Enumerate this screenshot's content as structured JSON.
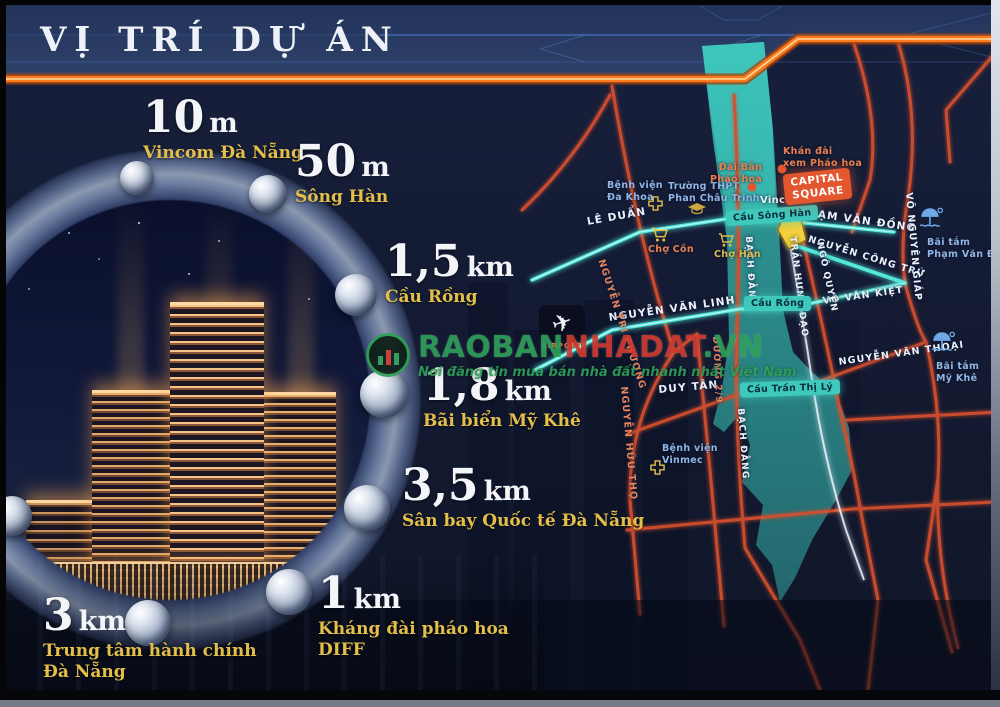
{
  "header": {
    "title": "VỊ TRÍ DỰ ÁN"
  },
  "distances": [
    {
      "value": "10",
      "unit": "m",
      "line1": "Vincom Đà Nẵng",
      "line2": ""
    },
    {
      "value": "50",
      "unit": "m",
      "line1": "Sông Hàn",
      "line2": ""
    },
    {
      "value": "1,5",
      "unit": "km",
      "line1": "Cầu Rồng",
      "line2": ""
    },
    {
      "value": "1,8",
      "unit": "km",
      "line1": "Bãi biển Mỹ Khê",
      "line2": ""
    },
    {
      "value": "3,5",
      "unit": "km",
      "line1": "Sân bay Quốc tế Đà Nẵng",
      "line2": ""
    },
    {
      "value": "1",
      "unit": "km",
      "line1": "Kháng đài pháo hoa",
      "line2": "DIFF"
    },
    {
      "value": "3",
      "unit": "km",
      "line1": "Trung tâm hành chính",
      "line2": "Đà Nẵng"
    }
  ],
  "map": {
    "streets": {
      "le_duan": "LÊ DUẨN",
      "pham_van_dong": "PHẠM VĂN ĐỒNG",
      "nguyen_cong_tru": "NGUYỄN CÔNG TRỨ",
      "vo_van_kiet": "VÕ VĂN KIỆT",
      "nguyen_van_linh": "NGUYỄN VĂN LINH",
      "nguyen_van_thoai": "NGUYỄN VĂN THOẠI",
      "duy_tan": "DUY TÂN",
      "vo_nguyen_giap": "VÕ NGUYÊN GIÁP",
      "bach_dang": "BẠCH ĐẰNG",
      "tran_hung_dao": "TRẦN HƯNG ĐẠO",
      "ngo_quyen": "NGÔ QUYỀN",
      "nguyen_tri_phuong": "NGUYỄN TRI PHƯƠNG",
      "nguyen_huu_tho": "NGUYỄN HỮU THỌ",
      "duong_2_9": "ĐƯỜNG 2/9"
    },
    "bridges": {
      "song_han": "Cầu Sông Hàn",
      "rong": "Cầu Rồng",
      "tran_thi_ly": "Cầu Trần Thị Lý"
    },
    "pois": {
      "benh_vien_da_khoa": {
        "line1": "Bệnh viện",
        "line2": "Đa Khoa"
      },
      "truong_thpt": {
        "line1": "Trường THPT",
        "line2": "Phan Châu Trinh"
      },
      "cho_con": "Chợ Cồn",
      "cho_han": "Chợ Hàn",
      "vincom": "Vincom",
      "khan_dai": {
        "line1": "Khán đài",
        "line2": "xem Pháo hoa"
      },
      "dai_ban": {
        "line1": "Đài Bắn",
        "line2": "Pháo hoa"
      },
      "capital_square": {
        "line1": "CAPITAL",
        "line2": "SQUARE"
      },
      "bai_tam_pvd": {
        "line1": "Bãi tắm",
        "line2": "Phạm Văn Đồng"
      },
      "bai_tam_my_khe": {
        "line1": "Bãi tắm",
        "line2": "Mỹ Khê"
      },
      "benh_vien_vinmec": {
        "line1": "Bệnh viện",
        "line2": "Vinmec"
      },
      "airport": "AIRPORT"
    },
    "colors": {
      "road_orange": "#d4502e",
      "road_teal": "#52e8da",
      "river": "#2f8f8f",
      "badge_orange": "#e4572e",
      "badge_teal": "#3fc8bc",
      "marker_yellow": "#f2cf3e",
      "label_gold": "#e3bf4a",
      "header_bar_orange": "#ff7a1a"
    }
  },
  "watermark": {
    "brand_part1": "RAOBAN",
    "brand_part2": "NHADAT",
    "brand_part3": ".VN",
    "tagline": "Nơi đăng tin mua bán nhà đất nhanh nhất Việt Nam"
  }
}
